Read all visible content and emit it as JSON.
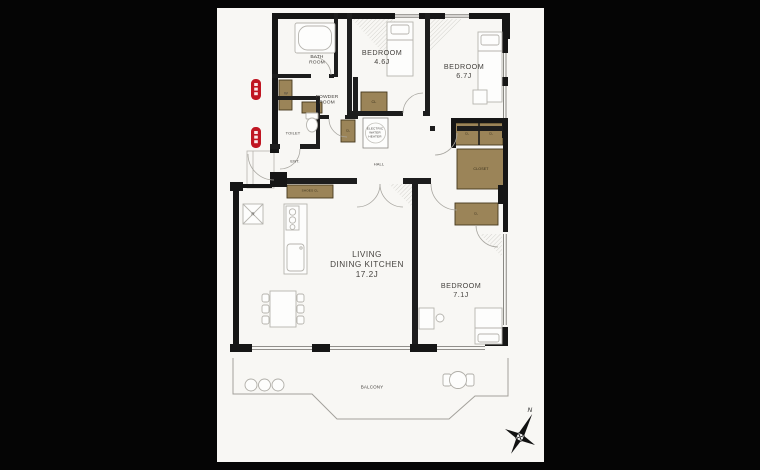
{
  "colors": {
    "background": "#050505",
    "sheet": "#f8f7f4",
    "wall": "#161616",
    "closet_fill": "#9b8458",
    "badge_red": "#c01622",
    "fixture_line": "#b6b4ae",
    "label_text": "#46433f"
  },
  "plan": {
    "bath_room": "BATH\nROOM",
    "powder_room": "POWDER\nROOM",
    "toilet": "TOILET",
    "entrance": "ENT.",
    "hall": "HALL",
    "bedroom_a": "BEDROOM\n4.6J",
    "bedroom_b": "BEDROOM\n6.7J",
    "bedroom_c": "BEDROOM\n7.1J",
    "ldk": "LIVING\nDINING KITCHEN\n17.2J",
    "balcony": "BALCONY",
    "washer": "W",
    "refrigerator": "R",
    "water_heater": "ELECTRIC\nWATER\nHEATER",
    "closet_small": "CL",
    "closet_large": "CLOSET",
    "shoes_closet": "SHOES CL",
    "compass_north": "N"
  }
}
